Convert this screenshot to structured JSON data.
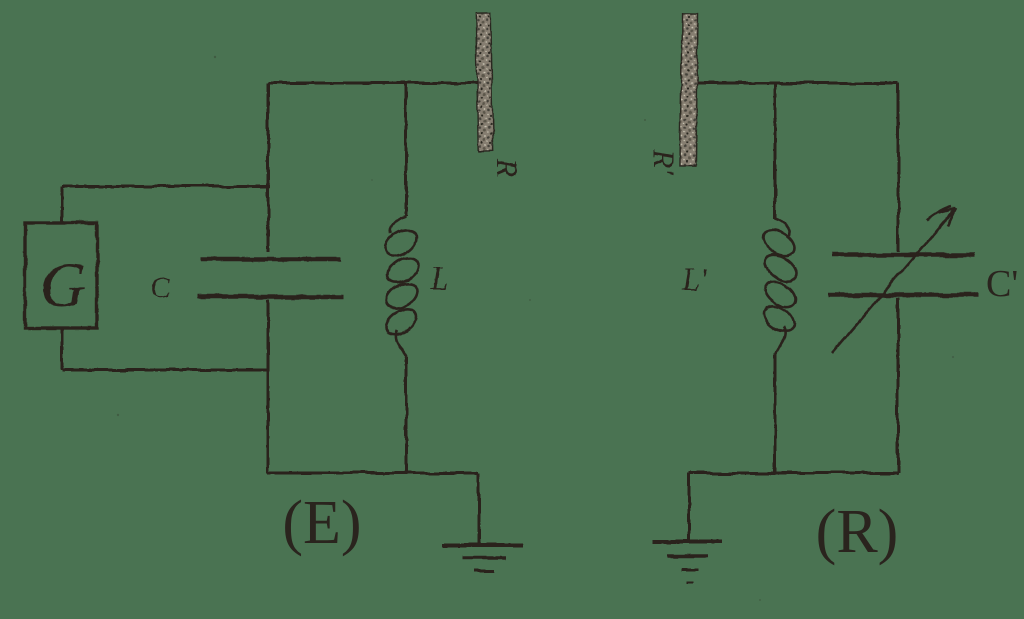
{
  "diagram": {
    "background_color": "#4a7352",
    "ink_color": "#2a241e",
    "antenna_fill_color": "#8a7f72",
    "left_circuit": {
      "caption": "(E)",
      "generator_label": "G",
      "capacitor_label": "C",
      "inductor_label": "L",
      "antenna_label": "R"
    },
    "right_circuit": {
      "caption": "(R)",
      "antenna_label": "R'",
      "inductor_label": "L'",
      "capacitor_label": "C'"
    }
  }
}
